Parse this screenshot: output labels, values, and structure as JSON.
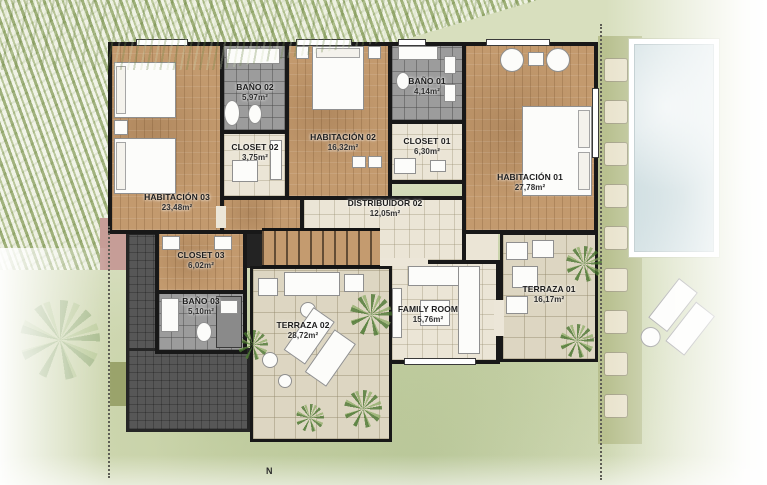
{
  "plan": {
    "north_label": "N",
    "rooms": {
      "habitacion01": {
        "name": "HABITACIÓN 01",
        "area": "27,78m²"
      },
      "habitacion02": {
        "name": "HABITACIÓN 02",
        "area": "16,32m²"
      },
      "habitacion03": {
        "name": "HABITACIÓN 03",
        "area": "23,48m²"
      },
      "bano01": {
        "name": "BAÑO 01",
        "area": "4,14m²"
      },
      "bano02": {
        "name": "BAÑO 02",
        "area": "5,97m²"
      },
      "bano03": {
        "name": "BAÑO 03",
        "area": "5,10m²"
      },
      "closet01": {
        "name": "CLOSET 01",
        "area": "6,30m²"
      },
      "closet02": {
        "name": "CLOSET 02",
        "area": "3,75m²"
      },
      "closet03": {
        "name": "CLOSET 03",
        "area": "6,02m²"
      },
      "distribuidor02": {
        "name": "DISTRIBUIDOR 02",
        "area": "12,05m²"
      },
      "family_room": {
        "name": "FAMILY ROOM",
        "area": "15,76m²"
      },
      "terraza01": {
        "name": "TERRAZA 01",
        "area": "16,17m²"
      },
      "terraza02": {
        "name": "TERRAZA 02",
        "area": "28,72m²"
      }
    },
    "colors": {
      "wall": "#181818",
      "wood_floor": "#c39a6e",
      "bath_tile": "#9c9c9c",
      "interior_tile": "#ebe5d6",
      "terrace_tile": "#ddd6c2",
      "patio_dark": "#575757",
      "pool_water": "#cfdee1",
      "grass": "#d8dfbe",
      "accent_pink": "#c69d97"
    }
  }
}
